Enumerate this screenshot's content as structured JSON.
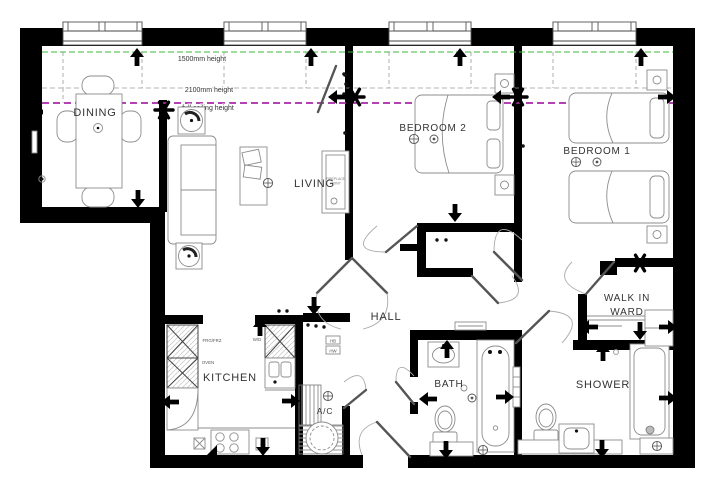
{
  "rooms": {
    "dining": "DINING",
    "living": "LIVING",
    "bedroom2": "BEDROOM 2",
    "bedroom1": "BEDROOM 1",
    "hall": "HALL",
    "kitchen": "KITCHEN",
    "ac": "A/C",
    "bath": "BATH",
    "shower": "SHOWER",
    "walkin_line1": "WALK IN",
    "walkin_line2": "WARD"
  },
  "ceiling_heights": {
    "h1500": "1500mm height",
    "h2100": "2100mm height",
    "hfull": "full ceiling height"
  },
  "appliances": {
    "fridge": "FRG/FRZ",
    "oven": "OVEN",
    "washer": "W/D",
    "hb": "HB",
    "hw": "HW",
    "fireplace_line1": "FIREPLACE",
    "fireplace_line2": "POINT"
  },
  "colors": {
    "wall": "#000000",
    "height_1500_line": "#3cb93c",
    "height_2100_line": "#9a9a9a",
    "full_ceiling_line": "#a828a8",
    "furniture_outline": "#8c8c8c",
    "label_text": "#333333"
  }
}
